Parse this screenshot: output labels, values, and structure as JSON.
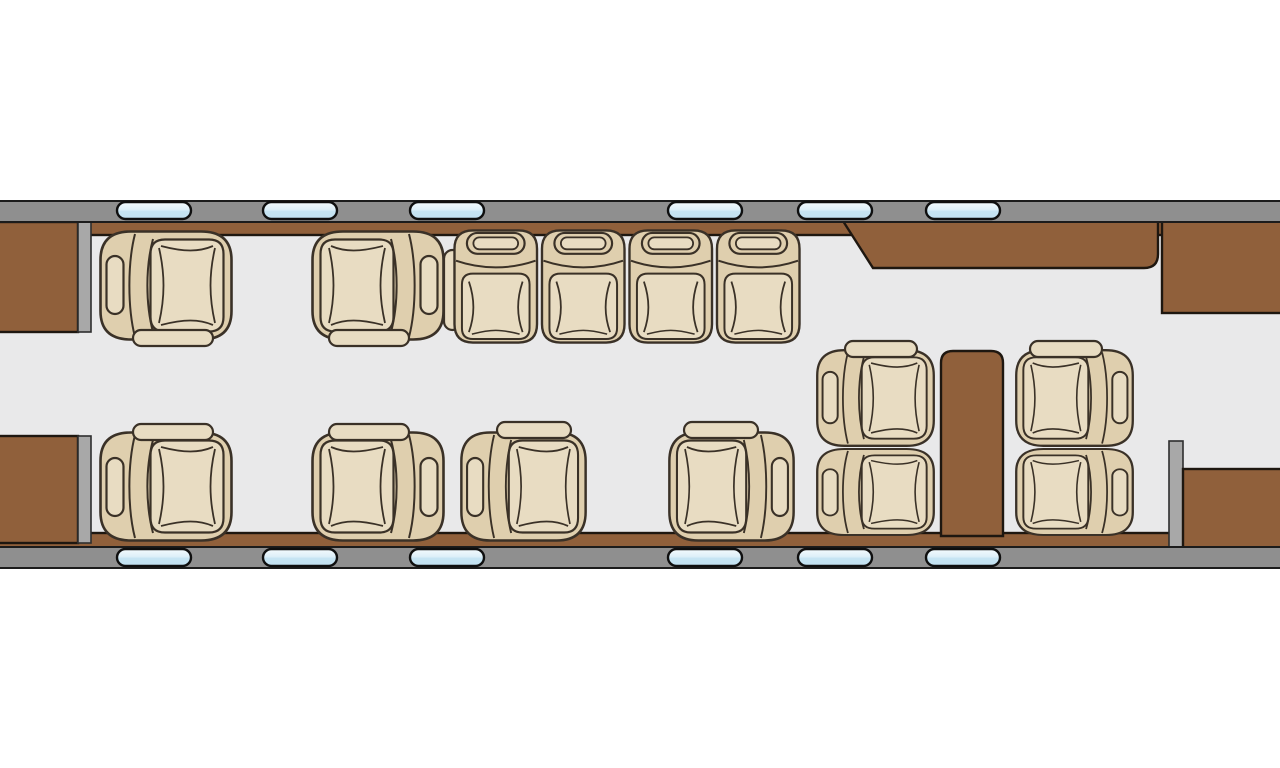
{
  "meta": {
    "diagram": "aircraft-cabin-floor-plan",
    "seat_total": 14,
    "club_seat_count": 10,
    "divan_seat_count": 4,
    "window_count": 12,
    "features": [
      "forward entry closets",
      "club-4 forward seating",
      "four-place divan",
      "facing club pair",
      "aft conference group with table",
      "credenza",
      "aft cabinets"
    ]
  },
  "colors": {
    "background": "#ffffff",
    "floor": "#e9e9ea",
    "wall_gray": "#8f8f8f",
    "wall_edge": "#1c1c1c",
    "partition_gray": "#a8a8a8",
    "wood_brown": "#90603b",
    "outline_dark": "#1e1710",
    "seat_outline": "#3a3127",
    "seat_base": "#dfcfae",
    "seat_cushion": "#e8dcc2",
    "window_blue": "#c6e4f3",
    "window_highlight": "#f4fbfe"
  },
  "cabin": {
    "floor": {
      "x": 0,
      "y": 205,
      "w": 1280,
      "h": 356
    },
    "walls": [
      {
        "name": "fuselage-wall-top",
        "x": -4,
        "y": 201,
        "w": 1288,
        "h": 21
      },
      {
        "name": "fuselage-wall-bottom",
        "x": -4,
        "y": 547,
        "w": 1288,
        "h": 21
      }
    ],
    "ledges": [
      {
        "name": "sidewall-ledge-top",
        "x": -4,
        "y": 219,
        "w": 1288,
        "h": 16
      },
      {
        "name": "sidewall-ledge-bottom",
        "x": -4,
        "y": 533,
        "w": 1288,
        "h": 16
      }
    ],
    "windows": {
      "w": 74,
      "h": 17,
      "rows": [
        {
          "name": "window-row-top",
          "y": 202
        },
        {
          "name": "window-row-bottom",
          "y": 549
        }
      ],
      "xs": [
        117,
        263,
        410,
        668,
        798,
        926
      ]
    },
    "furniture": [
      {
        "name": "entry-closet-forward",
        "type": "rect",
        "x": -4,
        "y": 222,
        "w": 82,
        "h": 110,
        "fill": "wood"
      },
      {
        "name": "entry-partition-forward",
        "type": "rect",
        "x": 78,
        "y": 222,
        "w": 13,
        "h": 110,
        "fill": "gray"
      },
      {
        "name": "entry-closet-aft",
        "type": "rect",
        "x": -4,
        "y": 436,
        "w": 82,
        "h": 107,
        "fill": "wood"
      },
      {
        "name": "entry-partition-aft",
        "type": "rect",
        "x": 78,
        "y": 436,
        "w": 13,
        "h": 107,
        "fill": "gray"
      },
      {
        "name": "credenza",
        "type": "path",
        "d": "M843,221 L1158,221 L1158,254 Q1158,268 1144,268 L873,268 Z",
        "fill": "wood"
      },
      {
        "name": "aft-cabinet-top",
        "type": "rect",
        "x": 1162,
        "y": 221,
        "w": 122,
        "h": 92,
        "fill": "wood"
      },
      {
        "name": "conference-table",
        "type": "path",
        "d": "M953,351 L991,351 Q1003,351 1003,363 L1003,536 L941,536 L941,363 Q941,351 953,351 Z",
        "fill": "wood"
      },
      {
        "name": "aft-partition",
        "type": "rect",
        "x": 1169,
        "y": 441,
        "w": 14,
        "h": 107,
        "fill": "gray"
      },
      {
        "name": "aft-cabinet-bottom",
        "type": "rect",
        "x": 1183,
        "y": 469,
        "w": 101,
        "h": 79,
        "fill": "wood"
      }
    ],
    "divan": {
      "name": "four-place-divan",
      "x": 452,
      "y": 228,
      "seat_w": 87.5,
      "seat_h": 117,
      "seats": 4,
      "armrest": {
        "x": 444,
        "y": 250,
        "w": 17,
        "h": 80
      }
    },
    "seats": [
      {
        "name": "club-seat-1",
        "x": 98,
        "y": 229,
        "w": 136,
        "h": 113,
        "face": "right",
        "flip_y": false,
        "bar": {
          "x": 133,
          "y": 330,
          "w": 80,
          "h": 16
        }
      },
      {
        "name": "club-seat-2",
        "x": 310,
        "y": 229,
        "w": 136,
        "h": 113,
        "face": "left",
        "flip_y": false,
        "bar": {
          "x": 329,
          "y": 330,
          "w": 80,
          "h": 16
        }
      },
      {
        "name": "club-seat-3",
        "x": 98,
        "y": 430,
        "w": 136,
        "h": 113,
        "face": "right",
        "flip_y": true,
        "bar": {
          "x": 133,
          "y": 424,
          "w": 80,
          "h": 16
        }
      },
      {
        "name": "club-seat-4",
        "x": 310,
        "y": 430,
        "w": 136,
        "h": 113,
        "face": "left",
        "flip_y": true,
        "bar": {
          "x": 329,
          "y": 424,
          "w": 80,
          "h": 16
        }
      },
      {
        "name": "club-seat-5",
        "x": 459,
        "y": 430,
        "w": 129,
        "h": 113,
        "face": "right",
        "flip_y": true,
        "bar": {
          "x": 497,
          "y": 422,
          "w": 74,
          "h": 16
        }
      },
      {
        "name": "club-seat-6",
        "x": 667,
        "y": 430,
        "w": 129,
        "h": 113,
        "face": "left",
        "flip_y": true,
        "bar": {
          "x": 684,
          "y": 422,
          "w": 74,
          "h": 16
        }
      },
      {
        "name": "club-seat-7",
        "x": 815,
        "y": 348,
        "w": 121,
        "h": 100,
        "face": "right",
        "flip_y": false,
        "bar": {
          "x": 845,
          "y": 341,
          "w": 72,
          "h": 16
        }
      },
      {
        "name": "club-seat-8",
        "x": 815,
        "y": 447,
        "w": 121,
        "h": 90,
        "face": "right",
        "flip_y": true,
        "bar": null
      },
      {
        "name": "club-seat-9",
        "x": 1014,
        "y": 348,
        "w": 121,
        "h": 100,
        "face": "left",
        "flip_y": false,
        "bar": {
          "x": 1030,
          "y": 341,
          "w": 72,
          "h": 16
        }
      },
      {
        "name": "club-seat-10",
        "x": 1014,
        "y": 447,
        "w": 121,
        "h": 90,
        "face": "left",
        "flip_y": true,
        "bar": null
      }
    ]
  }
}
